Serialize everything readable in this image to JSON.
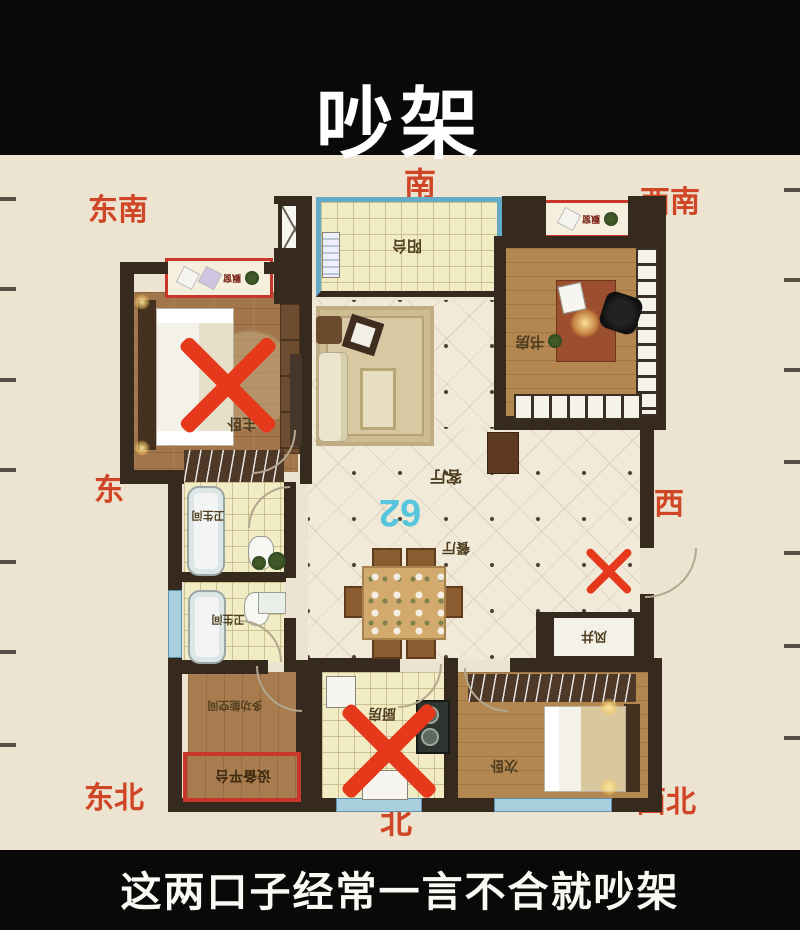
{
  "title": "吵架",
  "caption": "这两口子经常一言不合就吵架",
  "unit_number": "62",
  "compass": {
    "south": "南",
    "southeast": "东南",
    "southwest": "西南",
    "east": "东",
    "west": "西",
    "northeast": "东北",
    "north": "北",
    "northwest": "西北"
  },
  "rooms": {
    "balcony": "阳台",
    "master_bedroom": "主卧",
    "study": "书房",
    "living_room": "客厅",
    "dining_room": "餐厅",
    "bathroom_upper": "卫生间",
    "bathroom_lower": "卫生间",
    "kitchen": "厨房",
    "second_bedroom": "次卧",
    "wind_shaft": "风井",
    "multi_function_room": "多功能空间",
    "equipment_platform": "设备平台",
    "bay_window_left": "飘窗",
    "bay_window_right": "飘窗"
  },
  "annotations": {
    "x_marks": [
      "master-bed",
      "entry-door",
      "kitchen"
    ],
    "highlight_boxes": [
      "equipment-platform",
      "bay-window-left",
      "bay-window-right"
    ]
  },
  "colors": {
    "top_band": "#0b0908",
    "background": "#ece4d1",
    "compass_red": "#cf4526",
    "x_red": "#e6391b",
    "wall": "#362a1f",
    "unit_blue": "#57c5dc",
    "highlight_red": "#c8372a"
  }
}
